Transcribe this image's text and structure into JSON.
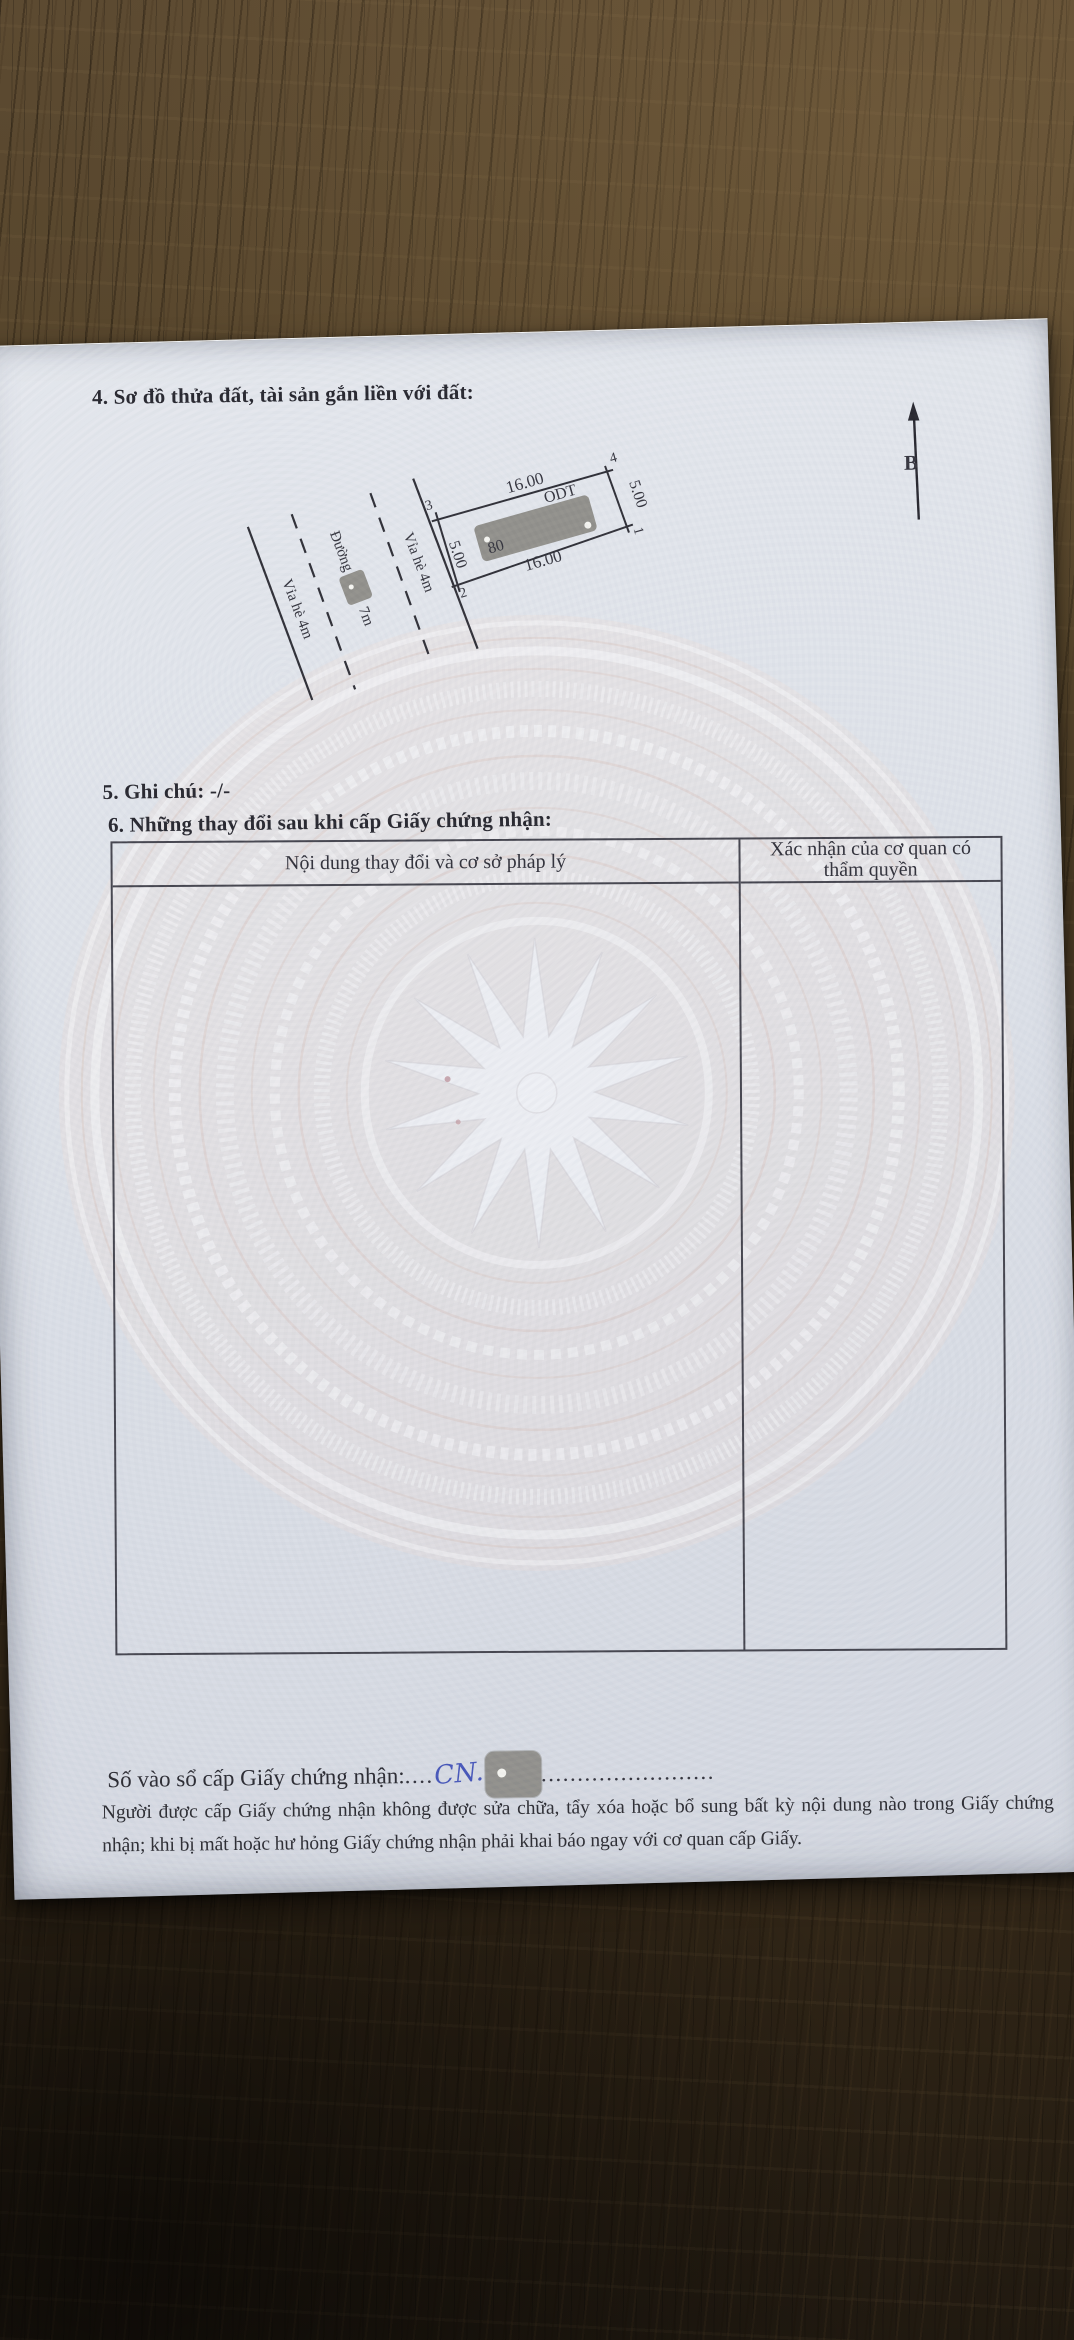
{
  "document": {
    "section4_title": "4. Sơ đồ thửa đất, tài sản gắn liền với đất:",
    "section5_note": "5. Ghi chú: -/-",
    "section6_title": "6. Những thay đổi sau khi cấp Giấy chứng nhận:"
  },
  "diagram": {
    "north_label": "B",
    "plot": {
      "corner_1": "1",
      "corner_2": "2",
      "corner_3": "3",
      "corner_4": "4",
      "length_top": "16.00",
      "length_bottom": "16.00",
      "width_left": "5.00",
      "width_right": "5.00",
      "land_use_code": "ODT",
      "area": "80"
    },
    "streets": {
      "sidewalk_inner": "Vỉa hè 4m",
      "road_prefix": "Đường",
      "road_suffix": "7m",
      "sidewalk_outer": "Vỉa hè 4m"
    }
  },
  "table": {
    "header_content": "Nội dung thay đổi và cơ sở pháp lý",
    "header_authority": "Xác nhận của cơ quan có thẩm quyền"
  },
  "footer": {
    "serial_label": "Số vào sổ cấp Giấy chứng nhận:",
    "serial_dots_before": "....",
    "serial_handwritten": "CN.",
    "serial_dots_after": "........................",
    "notice": "Người được cấp Giấy chứng nhận không được sửa chữa, tẩy xóa hoặc bổ sung bất kỳ nội dung nào trong Giấy chứng nhận; khi bị mất hoặc hư hỏng Giấy chứng nhận phải khai báo ngay với cơ quan cấp Giấy."
  }
}
